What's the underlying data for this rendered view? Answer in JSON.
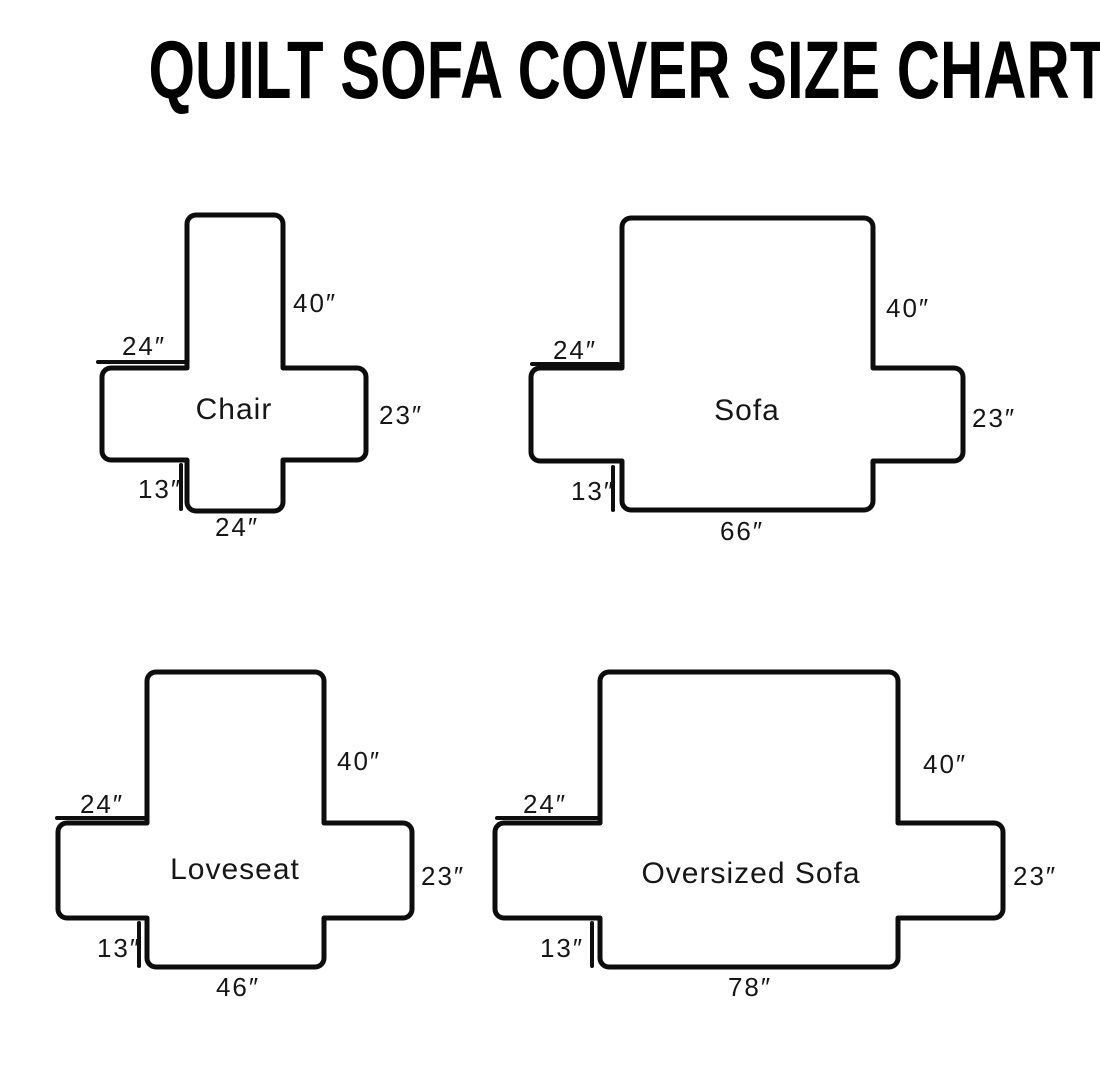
{
  "title": "QUILT SOFA COVER SIZE CHART",
  "canvas": {
    "width": 1100,
    "height": 1092,
    "background": "#ffffff",
    "stroke_color": "#0d0d0d",
    "text_color": "#161616"
  },
  "diagrams": [
    {
      "id": "chair",
      "name": "Chair",
      "dimensions": {
        "back_height": "40″",
        "arm_width": "24″",
        "side_depth": "23″",
        "front_drop": "13″",
        "bottom_width": "24″"
      },
      "shape": {
        "backLeft": 187,
        "backRight": 283,
        "top": 215,
        "armLeft": 102,
        "armRight": 366,
        "bandTop": 368,
        "bandBottom": 460,
        "bottom": 511
      },
      "labels": {
        "back": {
          "text": "40″",
          "x": 293,
          "y": 312,
          "anchor": "start"
        },
        "armTop": {
          "text": "24″",
          "x": 144,
          "y": 355,
          "anchor": "middle",
          "line": {
            "x1": 98,
            "y1": 362,
            "x2": 186,
            "y2": 362
          }
        },
        "side": {
          "text": "23″",
          "x": 379,
          "y": 424,
          "anchor": "start"
        },
        "frontDrop": {
          "text": "13″",
          "x": 160,
          "y": 498,
          "anchor": "middle",
          "line": {
            "x1": 181,
            "y1": 465,
            "x2": 181,
            "y2": 509
          }
        },
        "width": {
          "text": "24″",
          "x": 237,
          "y": 536,
          "anchor": "middle"
        },
        "name": {
          "x": 234,
          "y": 419
        }
      }
    },
    {
      "id": "sofa",
      "name": "Sofa",
      "dimensions": {
        "back_height": "40″",
        "arm_width": "24″",
        "side_depth": "23″",
        "front_drop": "13″",
        "bottom_width": "66″"
      },
      "shape": {
        "backLeft": 622,
        "backRight": 873,
        "top": 218,
        "armLeft": 531,
        "armRight": 963,
        "bandTop": 368,
        "bandBottom": 461,
        "bottom": 510
      },
      "labels": {
        "back": {
          "text": "40″",
          "x": 886,
          "y": 317,
          "anchor": "start"
        },
        "armTop": {
          "text": "24″",
          "x": 575,
          "y": 359,
          "anchor": "middle",
          "line": {
            "x1": 532,
            "y1": 364,
            "x2": 618,
            "y2": 364
          }
        },
        "side": {
          "text": "23″",
          "x": 972,
          "y": 427,
          "anchor": "start"
        },
        "frontDrop": {
          "text": "13″",
          "x": 593,
          "y": 500,
          "anchor": "middle",
          "line": {
            "x1": 613,
            "y1": 467,
            "x2": 613,
            "y2": 510
          }
        },
        "width": {
          "text": "66″",
          "x": 742,
          "y": 540,
          "anchor": "middle"
        },
        "name": {
          "x": 747,
          "y": 420
        }
      }
    },
    {
      "id": "loveseat",
      "name": "Loveseat",
      "dimensions": {
        "back_height": "40″",
        "arm_width": "24″",
        "side_depth": "23″",
        "front_drop": "13″",
        "bottom_width": "46″"
      },
      "shape": {
        "backLeft": 147,
        "backRight": 324,
        "top": 672,
        "armLeft": 58,
        "armRight": 412,
        "bandTop": 823,
        "bandBottom": 918,
        "bottom": 967
      },
      "labels": {
        "back": {
          "text": "40″",
          "x": 337,
          "y": 770,
          "anchor": "start"
        },
        "armTop": {
          "text": "24″",
          "x": 102,
          "y": 813,
          "anchor": "middle",
          "line": {
            "x1": 57,
            "y1": 818,
            "x2": 144,
            "y2": 818
          }
        },
        "side": {
          "text": "23″",
          "x": 421,
          "y": 885,
          "anchor": "start"
        },
        "frontDrop": {
          "text": "13″",
          "x": 119,
          "y": 957,
          "anchor": "middle",
          "line": {
            "x1": 139,
            "y1": 923,
            "x2": 139,
            "y2": 966
          }
        },
        "width": {
          "text": "46″",
          "x": 238,
          "y": 996,
          "anchor": "middle"
        },
        "name": {
          "x": 235,
          "y": 879
        }
      }
    },
    {
      "id": "oversized-sofa",
      "name": "Oversized Sofa",
      "dimensions": {
        "back_height": "40″",
        "arm_width": "24″",
        "side_depth": "23″",
        "front_drop": "13″",
        "bottom_width": "78″"
      },
      "shape": {
        "backLeft": 600,
        "backRight": 898,
        "top": 672,
        "armLeft": 495,
        "armRight": 1003,
        "bandTop": 823,
        "bandBottom": 918,
        "bottom": 967
      },
      "labels": {
        "back": {
          "text": "40″",
          "x": 923,
          "y": 773,
          "anchor": "start"
        },
        "armTop": {
          "text": "24″",
          "x": 545,
          "y": 813,
          "anchor": "middle",
          "line": {
            "x1": 497,
            "y1": 818,
            "x2": 598,
            "y2": 818
          }
        },
        "side": {
          "text": "23″",
          "x": 1013,
          "y": 885,
          "anchor": "start"
        },
        "frontDrop": {
          "text": "13″",
          "x": 562,
          "y": 957,
          "anchor": "middle",
          "line": {
            "x1": 592,
            "y1": 923,
            "x2": 592,
            "y2": 966
          }
        },
        "width": {
          "text": "78″",
          "x": 750,
          "y": 996,
          "anchor": "middle"
        },
        "name": {
          "x": 751,
          "y": 883
        }
      }
    }
  ]
}
